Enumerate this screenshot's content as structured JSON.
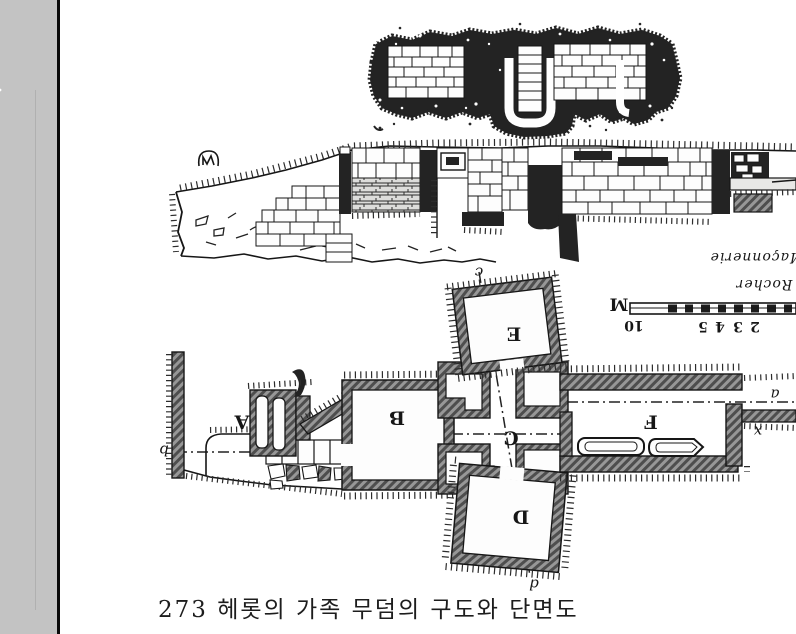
{
  "page": {
    "paper_color": "#ffffff",
    "gutter_color": "#c3c3c3",
    "ink_color": "#1c1c1c"
  },
  "figure": {
    "caption": "273 헤롯의 가족 무덤의 구도와 단면도",
    "rooms": {
      "a": "A",
      "b": "B",
      "c": "C",
      "d": "D",
      "e": "E",
      "f": "F"
    },
    "markers": {
      "left": "b",
      "top": "c",
      "bottom": "d",
      "right": "a",
      "x": "x"
    },
    "notes": {
      "masonry": "Maçonnerie",
      "rock": "Rocher"
    },
    "scale": {
      "unit": "M",
      "numbers": [
        "10",
        "5",
        "4",
        "3",
        "2"
      ]
    }
  }
}
